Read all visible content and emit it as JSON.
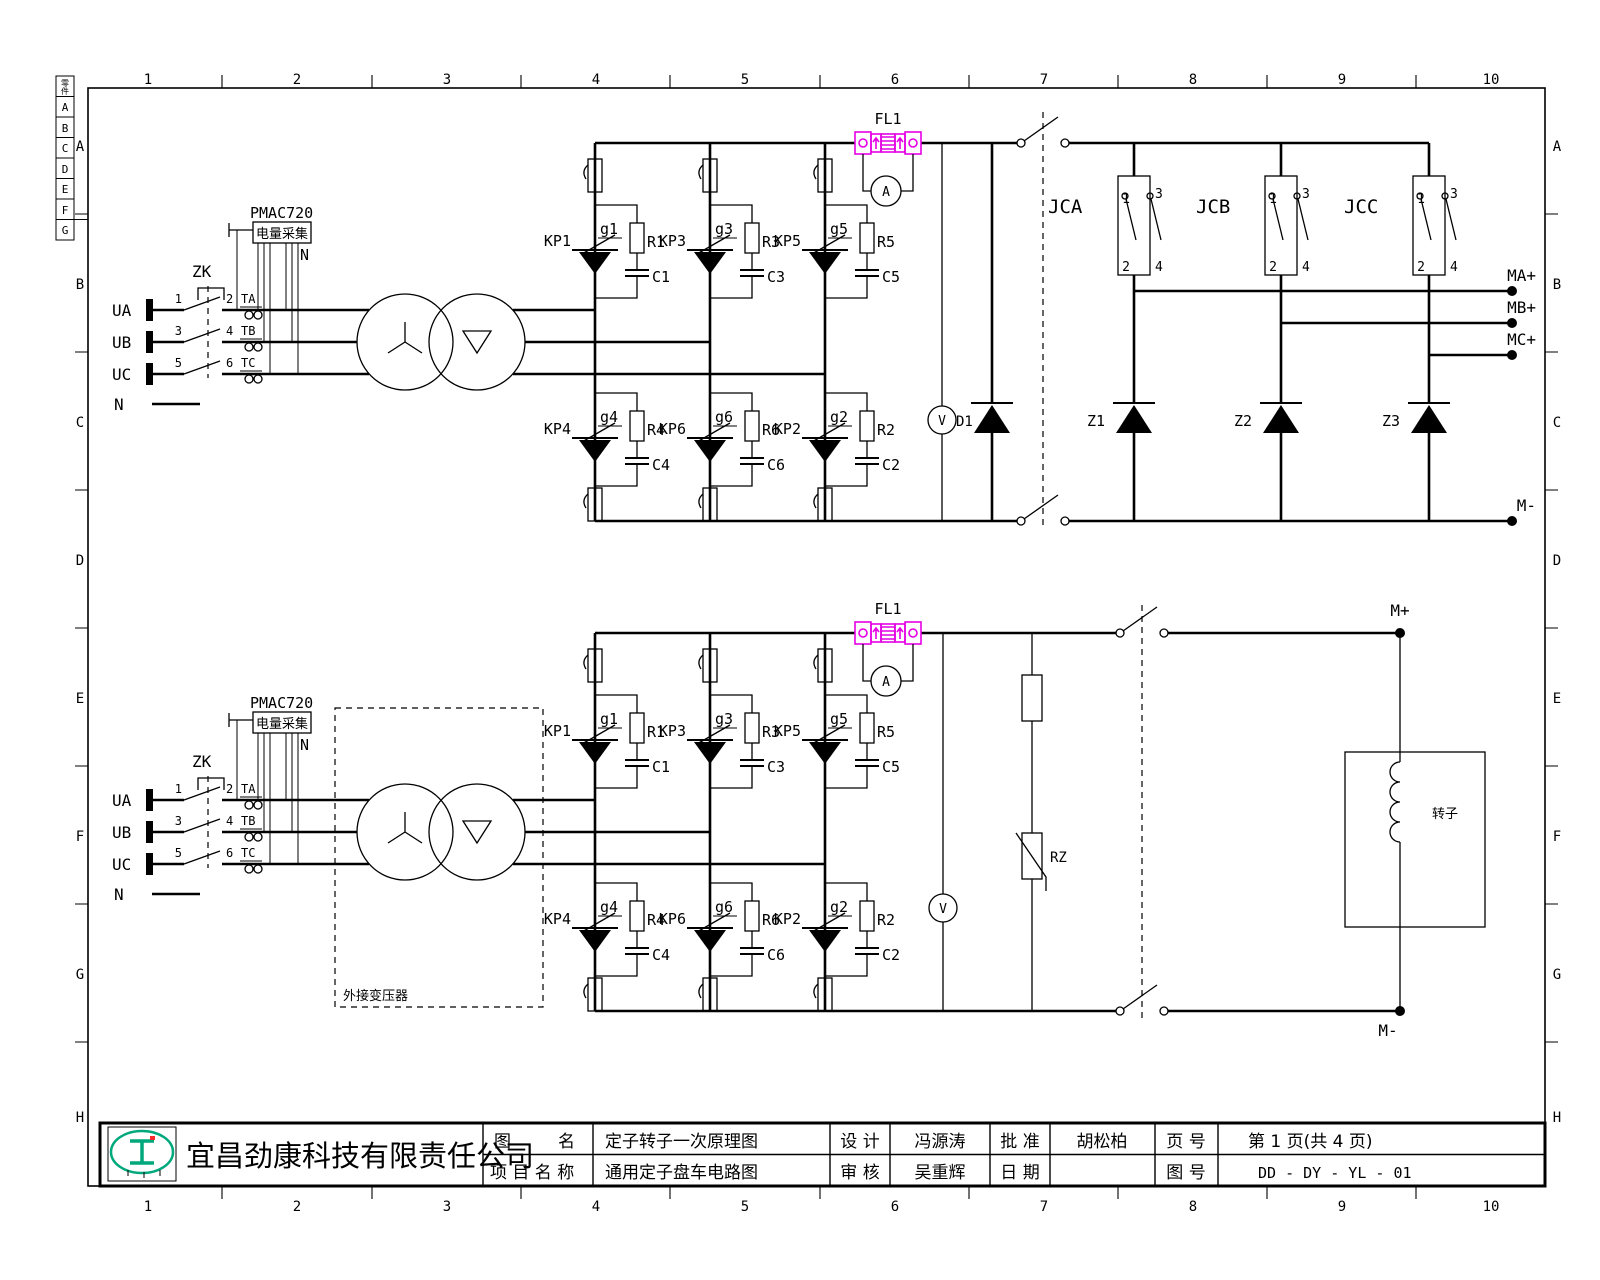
{
  "colors": {
    "line": "#000000",
    "shunt_magenta": "#e400e4",
    "logo_green": "#00a87c",
    "logo_red": "#ff2a2a",
    "background": "#ffffff"
  },
  "border": {
    "cols": [
      "1",
      "2",
      "3",
      "4",
      "5",
      "6",
      "7",
      "8",
      "9",
      "10"
    ],
    "rows": [
      "A",
      "B",
      "C",
      "D",
      "E",
      "F",
      "G",
      "H"
    ],
    "legend_head": "零件",
    "legend": [
      "A",
      "B",
      "C",
      "D",
      "E",
      "F",
      "G"
    ]
  },
  "input": {
    "phases": [
      "UA",
      "UB",
      "UC"
    ],
    "neutral": "N",
    "breaker": "ZK",
    "lp": [
      "1",
      "3",
      "5"
    ],
    "rp": [
      "2",
      "4",
      "6"
    ],
    "cts": [
      "TA",
      "TB",
      "TC"
    ],
    "pmac": "PMAC720",
    "pmac_box": "电量采集",
    "pmac_n": "N"
  },
  "bridge": {
    "upper": [
      {
        "kp": "KP1",
        "g": "g1",
        "r": "R1",
        "c": "C1"
      },
      {
        "kp": "KP3",
        "g": "g3",
        "r": "R3",
        "c": "C3"
      },
      {
        "kp": "KP5",
        "g": "g5",
        "r": "R5",
        "c": "C5"
      }
    ],
    "lower": [
      {
        "kp": "KP4",
        "g": "g4",
        "r": "R4",
        "c": "C4"
      },
      {
        "kp": "KP6",
        "g": "g6",
        "r": "R6",
        "c": "C6"
      },
      {
        "kp": "KP2",
        "g": "g2",
        "r": "R2",
        "c": "C2"
      }
    ]
  },
  "stator": {
    "fl": "FL1",
    "am": "A",
    "vm": "V",
    "d": "D1",
    "jc": [
      "JCA",
      "JCB",
      "JCC"
    ],
    "p1": "1",
    "p2": "2",
    "p3": "3",
    "p4": "4",
    "z": [
      "Z1",
      "Z2",
      "Z3"
    ],
    "out": [
      "MA+",
      "MB+",
      "MC+"
    ],
    "neg": "M-"
  },
  "rotor": {
    "fl": "FL1",
    "am": "A",
    "vm": "V",
    "rz": "RZ",
    "ext": "外接变压器",
    "winding": "转子",
    "pos": "M+",
    "neg": "M-"
  },
  "title_block": {
    "company": "宜昌劲康科技有限责任公司",
    "fig_l1": "图",
    "fig_l2": "名",
    "fig_name": "定子转子一次原理图",
    "proj_label": "项 目 名 称",
    "proj_name": "通用定子盘车电路图",
    "design_label": "设  计",
    "designer": "冯源涛",
    "review_label": "审  核",
    "reviewer": "吴重辉",
    "approve_label": "批  准",
    "approver": "胡松柏",
    "date_label": "日  期",
    "date_value": "",
    "page_label": "页  号",
    "page_value": "第 1 页(共 4 页)",
    "dwg_label": "图  号",
    "dwg_value": "DD - DY - YL - 01"
  }
}
